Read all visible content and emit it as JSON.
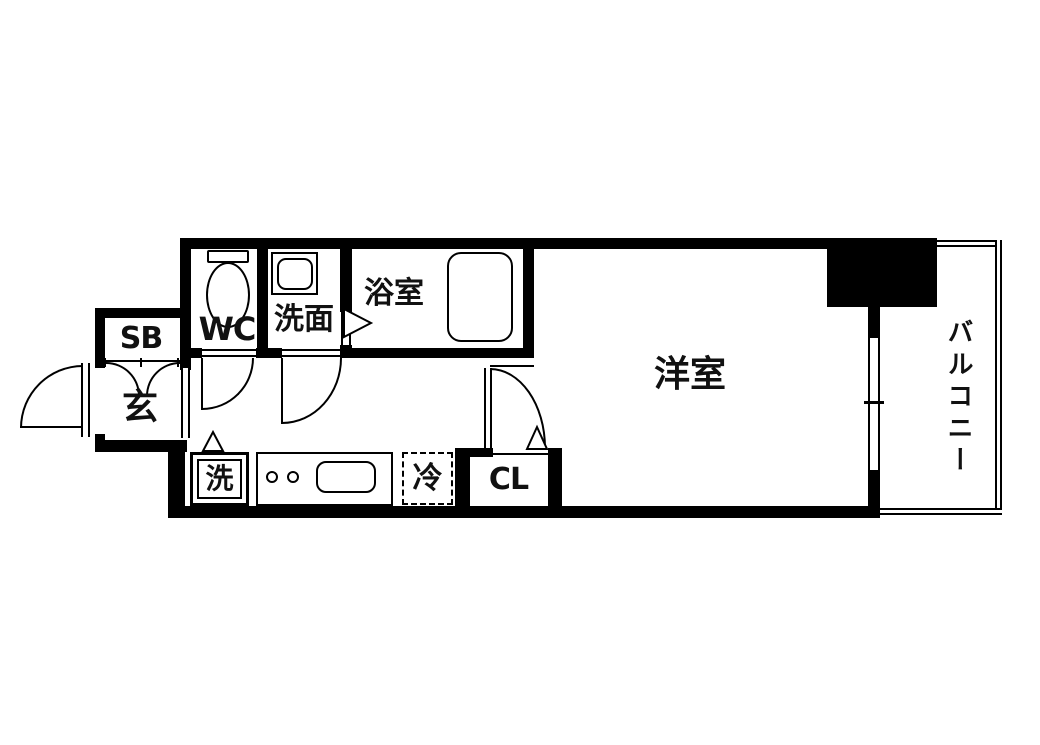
{
  "floorplan": {
    "rooms": {
      "shoe_box": {
        "label": "SB"
      },
      "entrance": {
        "label": "玄"
      },
      "toilet": {
        "label": "WC"
      },
      "washroom": {
        "label": "洗面"
      },
      "bathroom": {
        "label": "浴室"
      },
      "western_room": {
        "label": "洋室"
      },
      "closet": {
        "label": "CL"
      },
      "balcony": {
        "label": "バルコニー"
      },
      "washing_machine": {
        "label": "洗"
      },
      "refrigerator": {
        "label": "冷"
      }
    },
    "colors": {
      "wall": "#000000",
      "background": "#ffffff",
      "text": "#111111"
    }
  }
}
